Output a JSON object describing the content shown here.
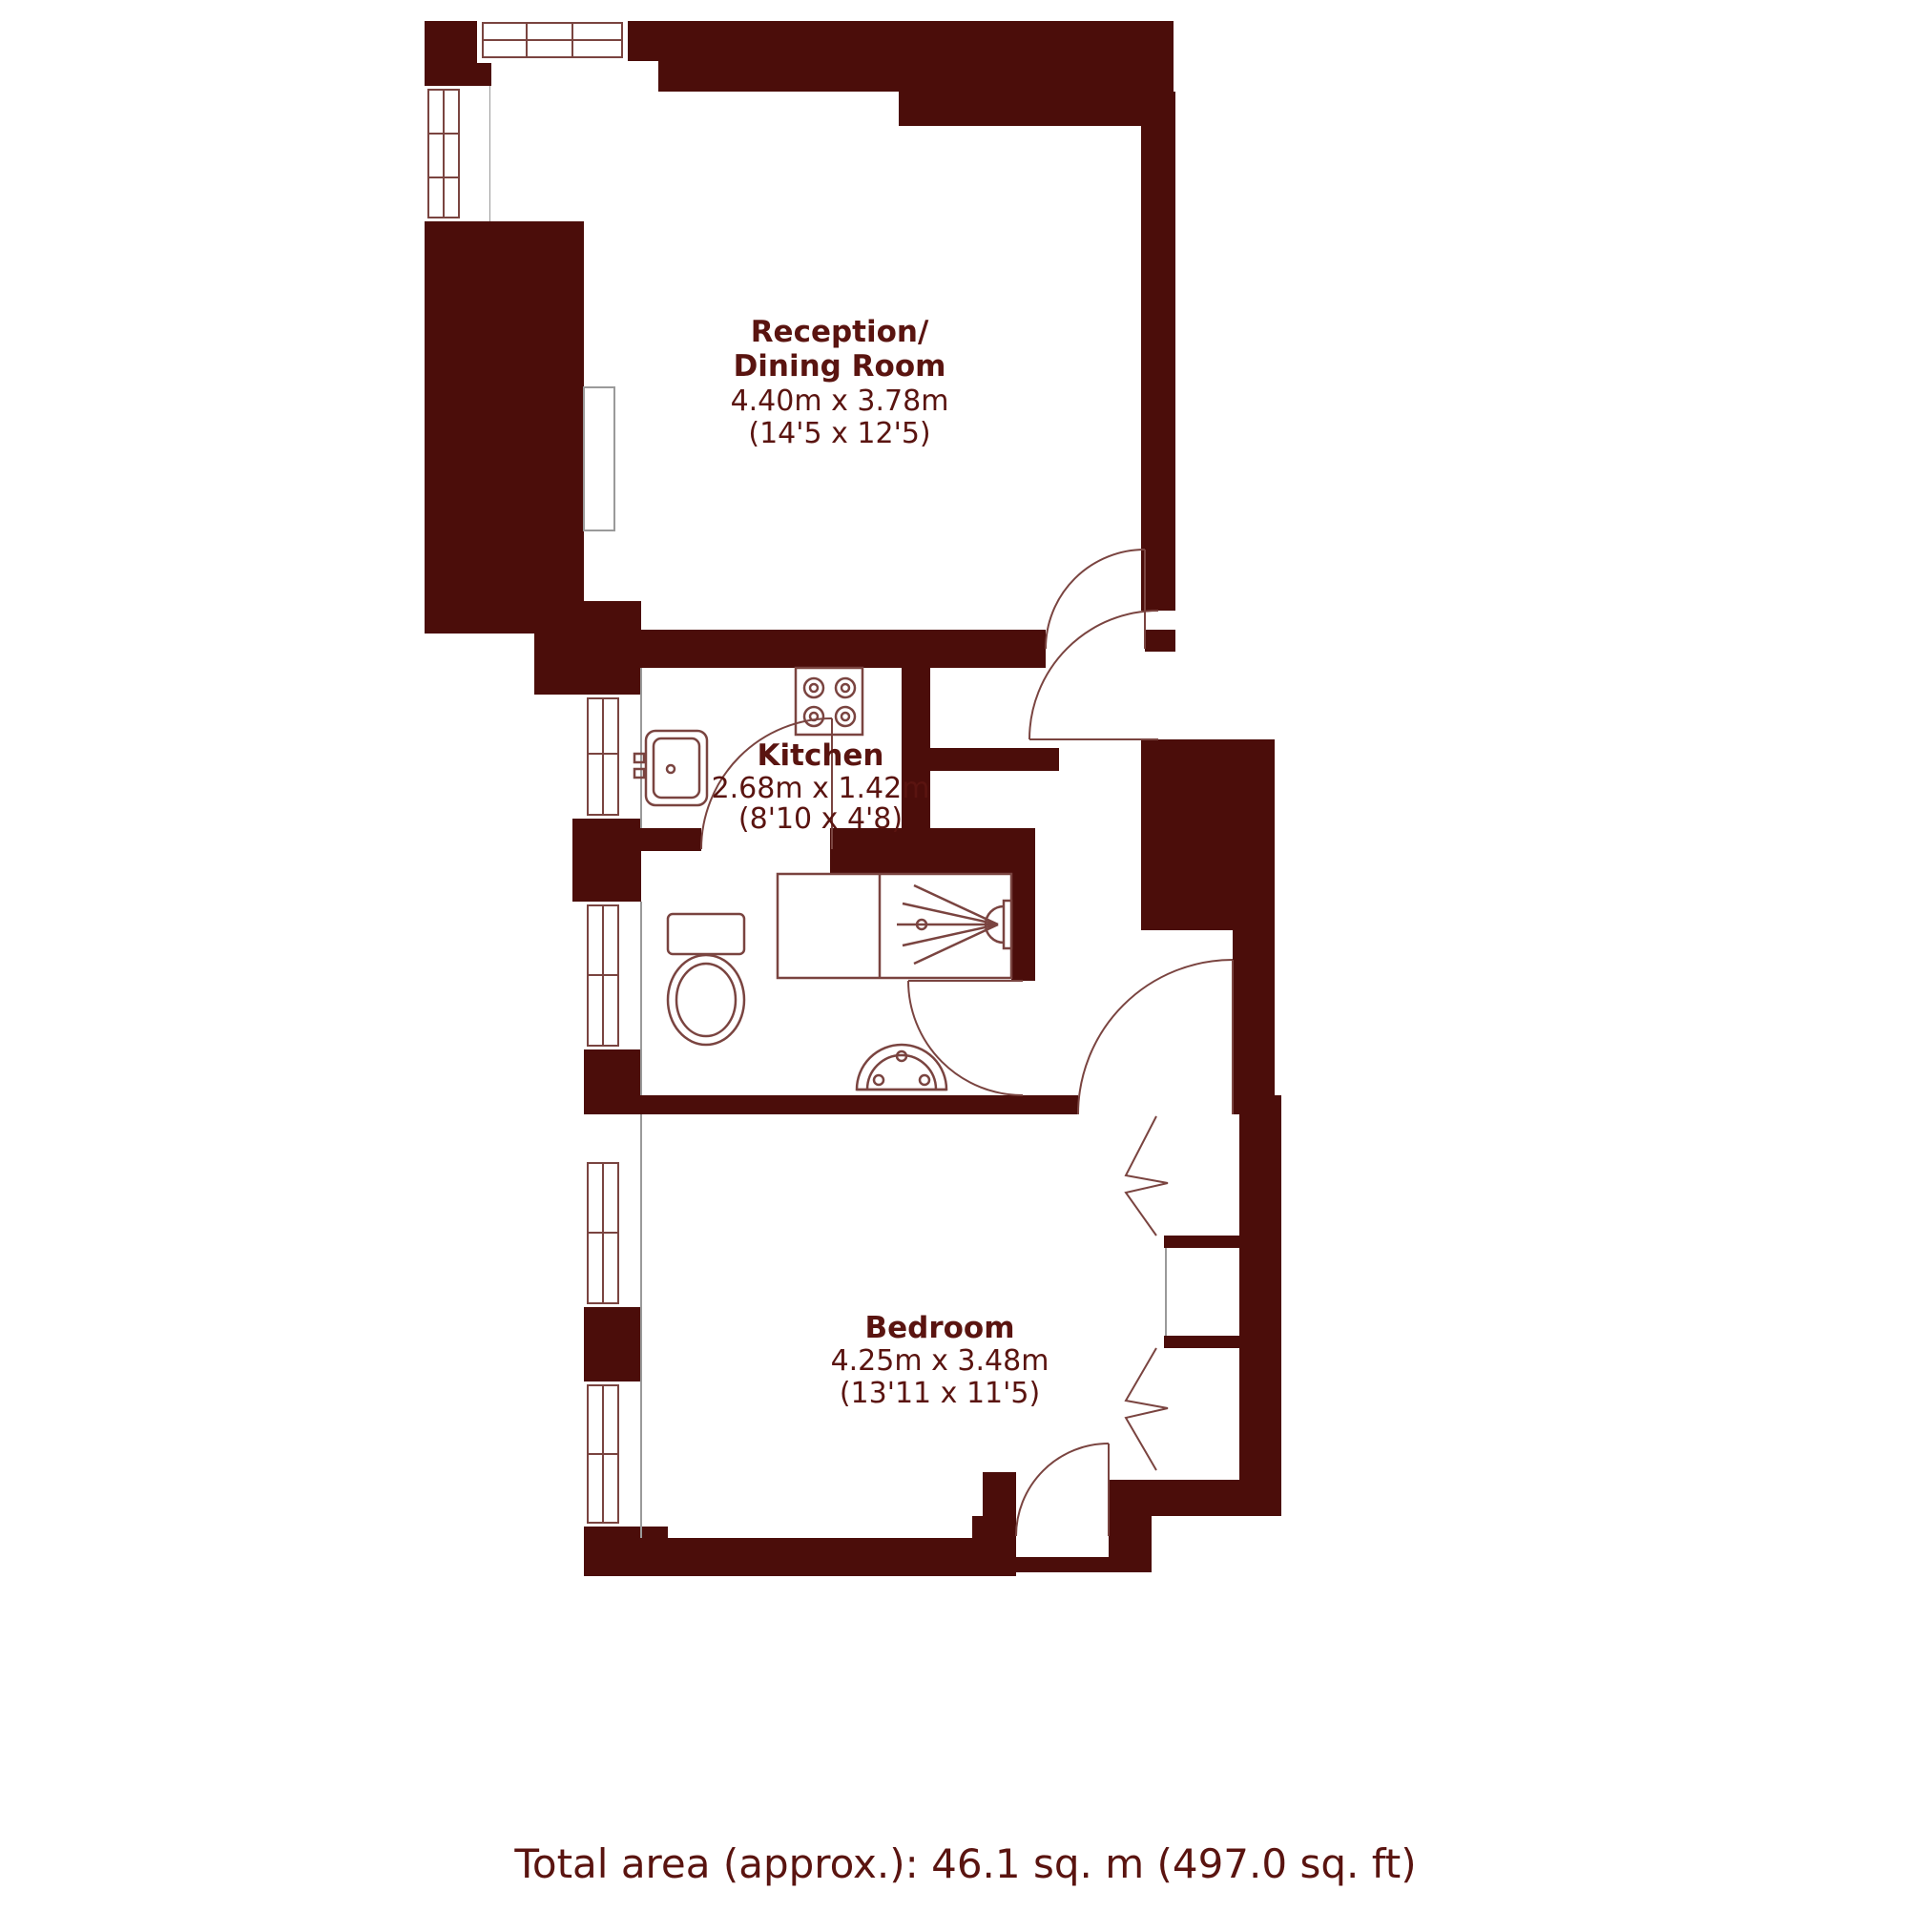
{
  "rooms": {
    "reception": {
      "name_line1": "Reception/",
      "name_line2": "Dining Room",
      "size_metric": "4.40m x 3.78m",
      "size_imperial": "(14'5 x 12'5)"
    },
    "kitchen": {
      "name": "Kitchen",
      "size_metric": "2.68m x 1.42m",
      "size_imperial": "(8'10 x 4'8)"
    },
    "bedroom": {
      "name": "Bedroom",
      "size_metric": "4.25m x 3.48m",
      "size_imperial": "(13'11 x 11'5)"
    }
  },
  "footer": {
    "total_area_label": "Total area (approx.): 46.1 sq. m (497.0 sq. ft)"
  },
  "colors": {
    "wall": "#4b0d0a",
    "fixture_line": "#7a4440",
    "label_text": "#5a1410",
    "interior_line": "#9a9a9a",
    "background": "#ffffff"
  },
  "fixtures": {
    "hob": "hob-4-burner-icon",
    "sink": "kitchen-sink-icon",
    "shower": "shower-icon",
    "toilet": "toilet-icon",
    "basin": "hand-basin-icon",
    "window": "window-icon",
    "door": "door-swing-icon"
  }
}
